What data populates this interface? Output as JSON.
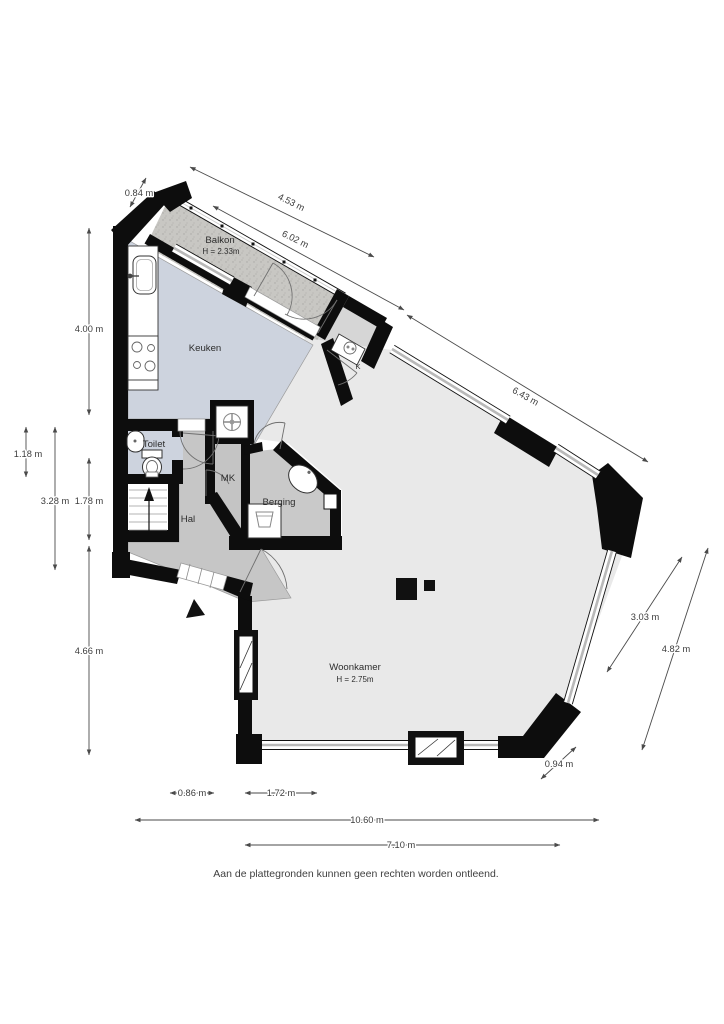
{
  "fp": {
    "rooms": {
      "balkon": {
        "label": "Balkon",
        "height": "H = 2.33m"
      },
      "keuken": {
        "label": "Keuken"
      },
      "toilet": {
        "label": "Toilet"
      },
      "hal": {
        "label": "Hal"
      },
      "mk": {
        "label": "MK"
      },
      "berging": {
        "label": "Berging"
      },
      "woonkamer": {
        "label": "Woonkamer",
        "height": "H = 2.75m"
      },
      "boiler": {
        "label": "K"
      }
    },
    "dims": {
      "step_top": "0.84 m",
      "balkon_inner": "4.53 m",
      "balkon_outer": "6.02 m",
      "facade_ne": "6.43 m",
      "left_top": "4.00 m",
      "left_a": "1.18 m",
      "left_b": "3.28 m",
      "left_c": "1.78 m",
      "left_d": "4.66 m",
      "right_a": "3.03 m",
      "right_b": "4.82 m",
      "corner_se": "0.94 m",
      "bottom_a": "0.86 m",
      "bottom_b": "1.72 m",
      "bottom_total": "10.60 m",
      "bottom_inner": "7.10 m"
    },
    "disclaimer": "Aan de plattegronden kunnen geen rechten worden ontleend.",
    "icons": {
      "entrance_marker": "triangle-up",
      "stairs_direction": "arrow-up",
      "ventilation_unit": "fan",
      "stove": "four-burners",
      "sink": "basin"
    },
    "colors": {
      "wall": "#0d0d0d",
      "floor_main": "#e9e9e9",
      "floor_wet": "#cdd3de",
      "floor_hall": "#c6c6c6",
      "floor_storage": "#c9c9c9",
      "balcony": "#c8c7c3",
      "dimension_text": "#3c3c3c"
    }
  }
}
